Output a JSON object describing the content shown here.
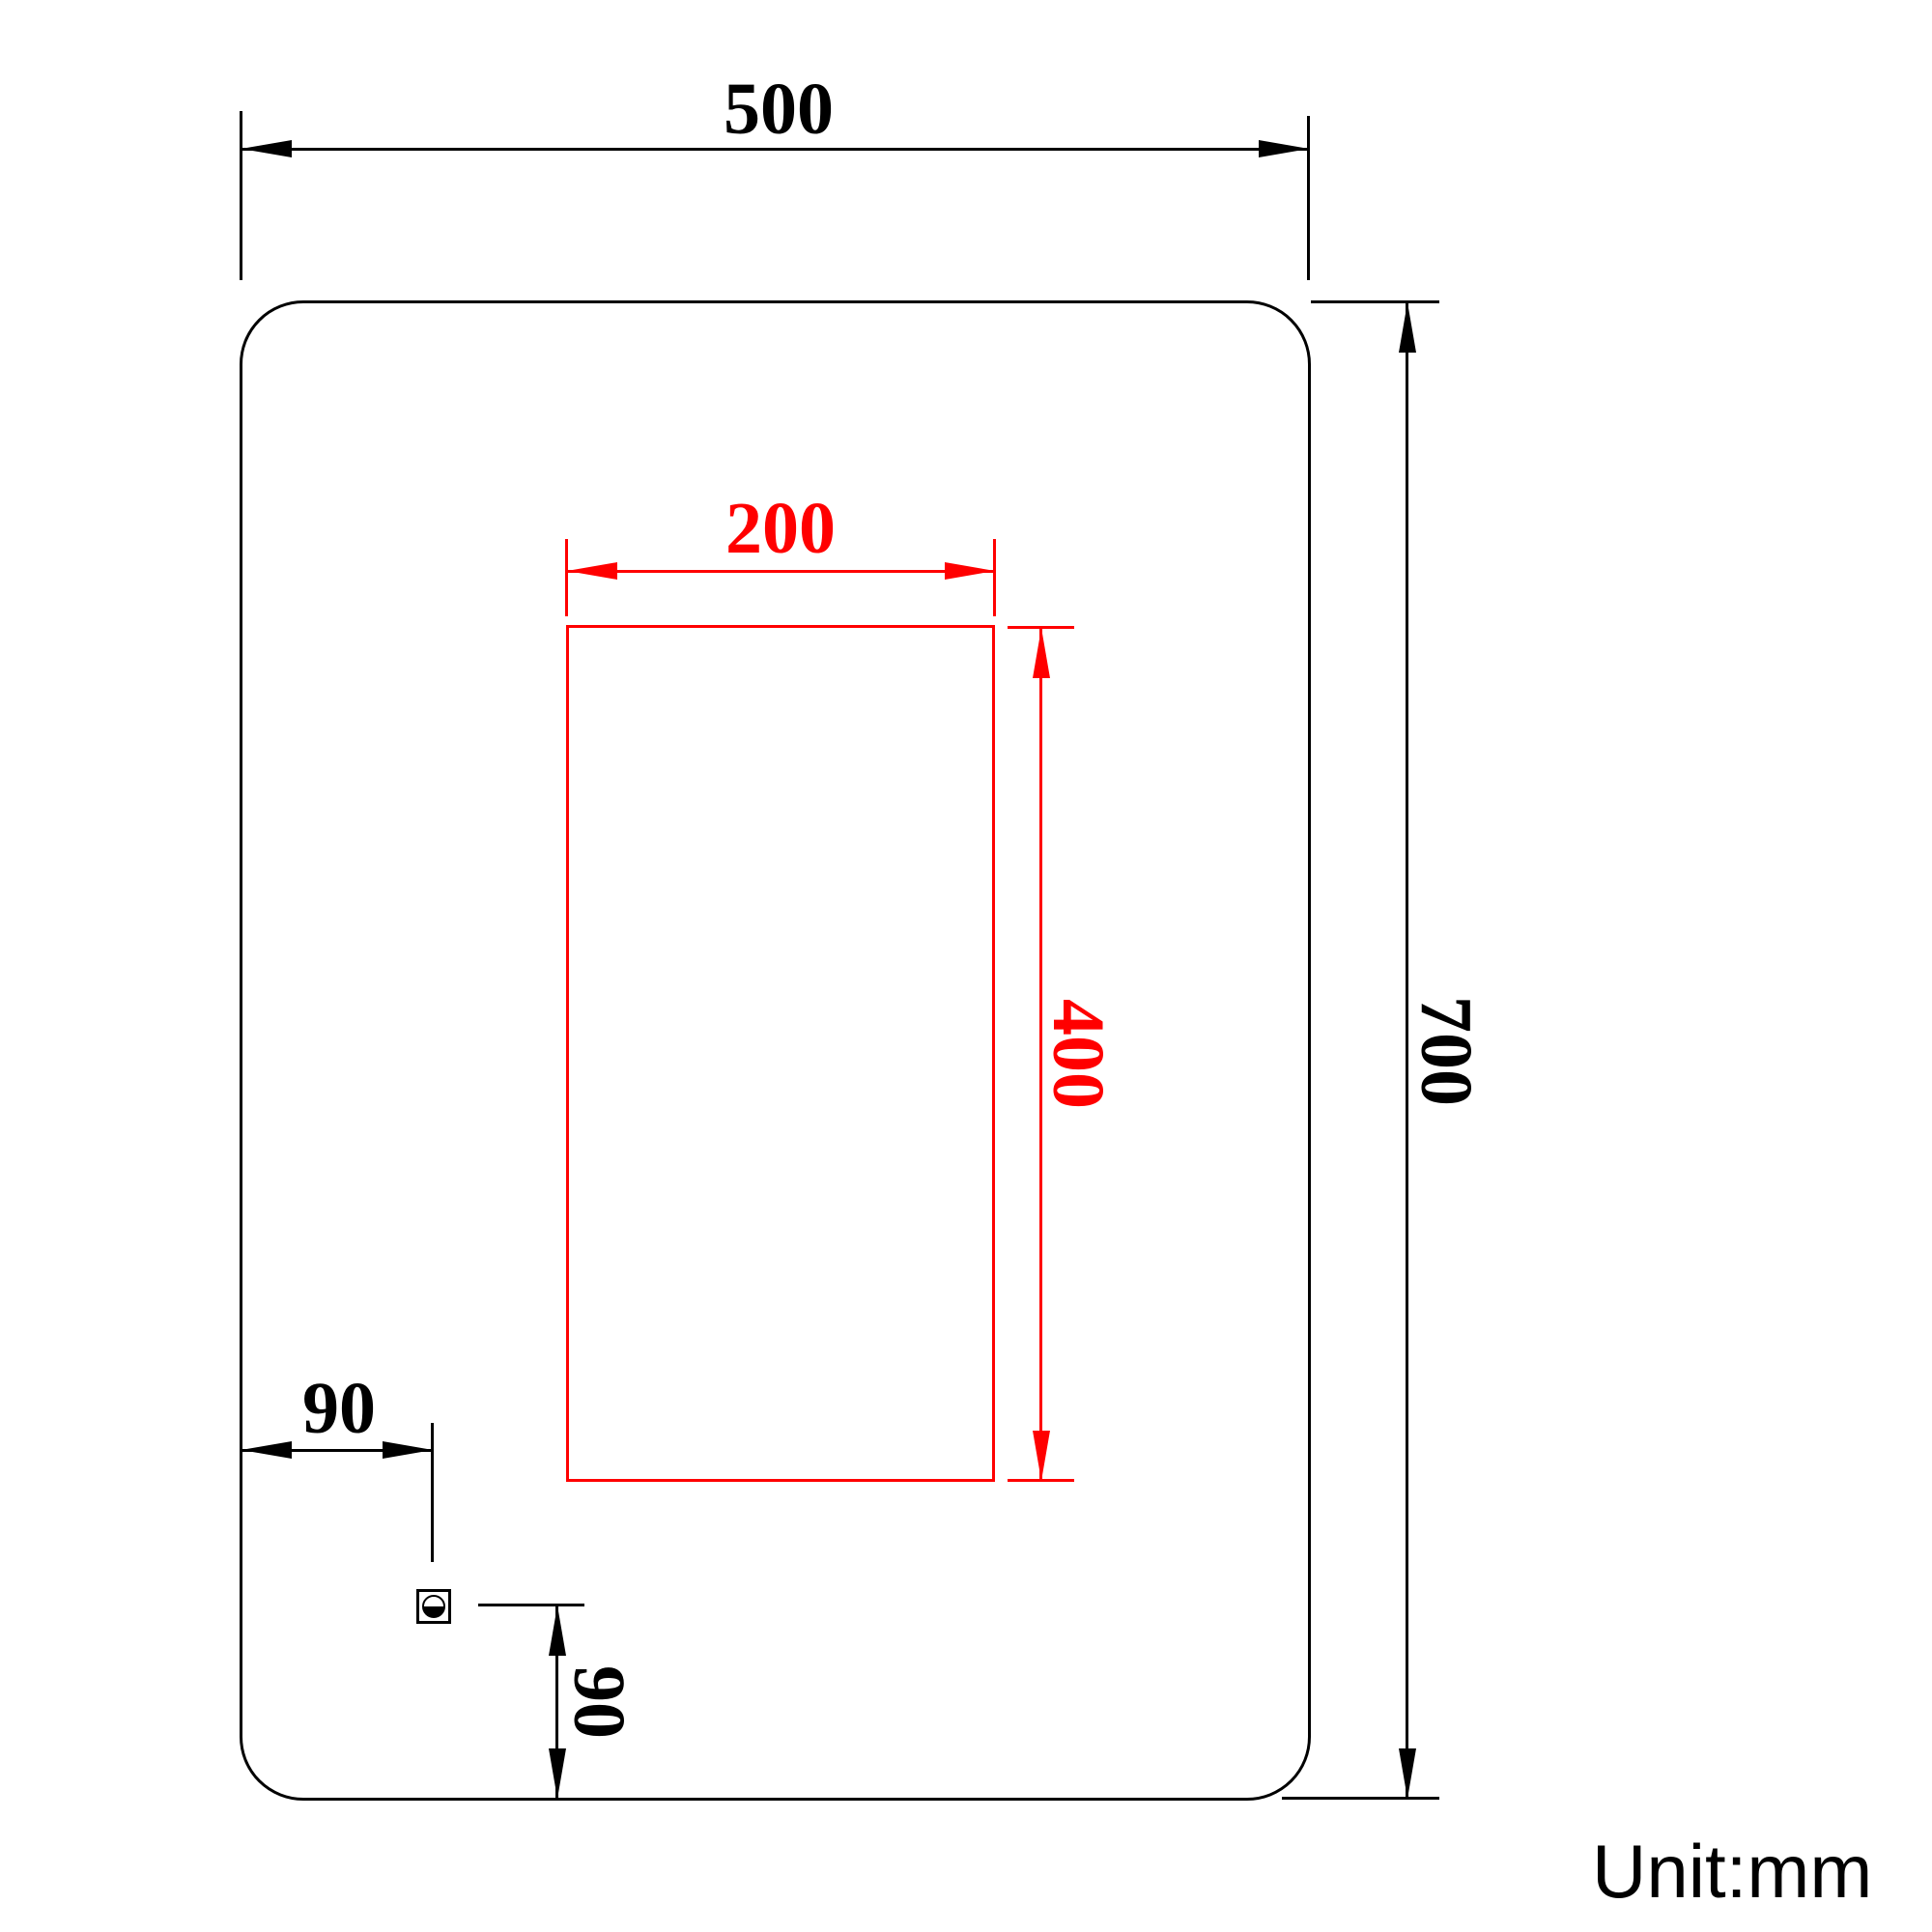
{
  "unit_note": "Unit:mm",
  "colors": {
    "outline": "#000000",
    "highlight": "#ff0000",
    "background": "#ffffff"
  },
  "drawing": {
    "type": "dimension-diagram",
    "outer_outline": {
      "width_mm": 500,
      "height_mm": 700,
      "corner": "rounded"
    },
    "inner_outline": {
      "width_mm": 200,
      "height_mm": 400,
      "color": "#ff0000"
    },
    "sensor_offset": {
      "from_left_mm": 90,
      "from_bottom_mm": 90
    }
  },
  "dims": {
    "outer_width": {
      "label": "500",
      "value_mm": 500,
      "orientation": "horizontal",
      "color": "#000000"
    },
    "outer_height": {
      "label": "700",
      "value_mm": 700,
      "orientation": "vertical",
      "color": "#000000"
    },
    "inner_width": {
      "label": "200",
      "value_mm": 200,
      "orientation": "horizontal",
      "color": "#ff0000"
    },
    "inner_height": {
      "label": "400",
      "value_mm": 400,
      "orientation": "vertical",
      "color": "#ff0000"
    },
    "sensor_x": {
      "label": "90",
      "value_mm": 90,
      "orientation": "horizontal",
      "color": "#000000"
    },
    "sensor_y": {
      "label": "90",
      "value_mm": 90,
      "orientation": "vertical",
      "color": "#000000"
    }
  }
}
